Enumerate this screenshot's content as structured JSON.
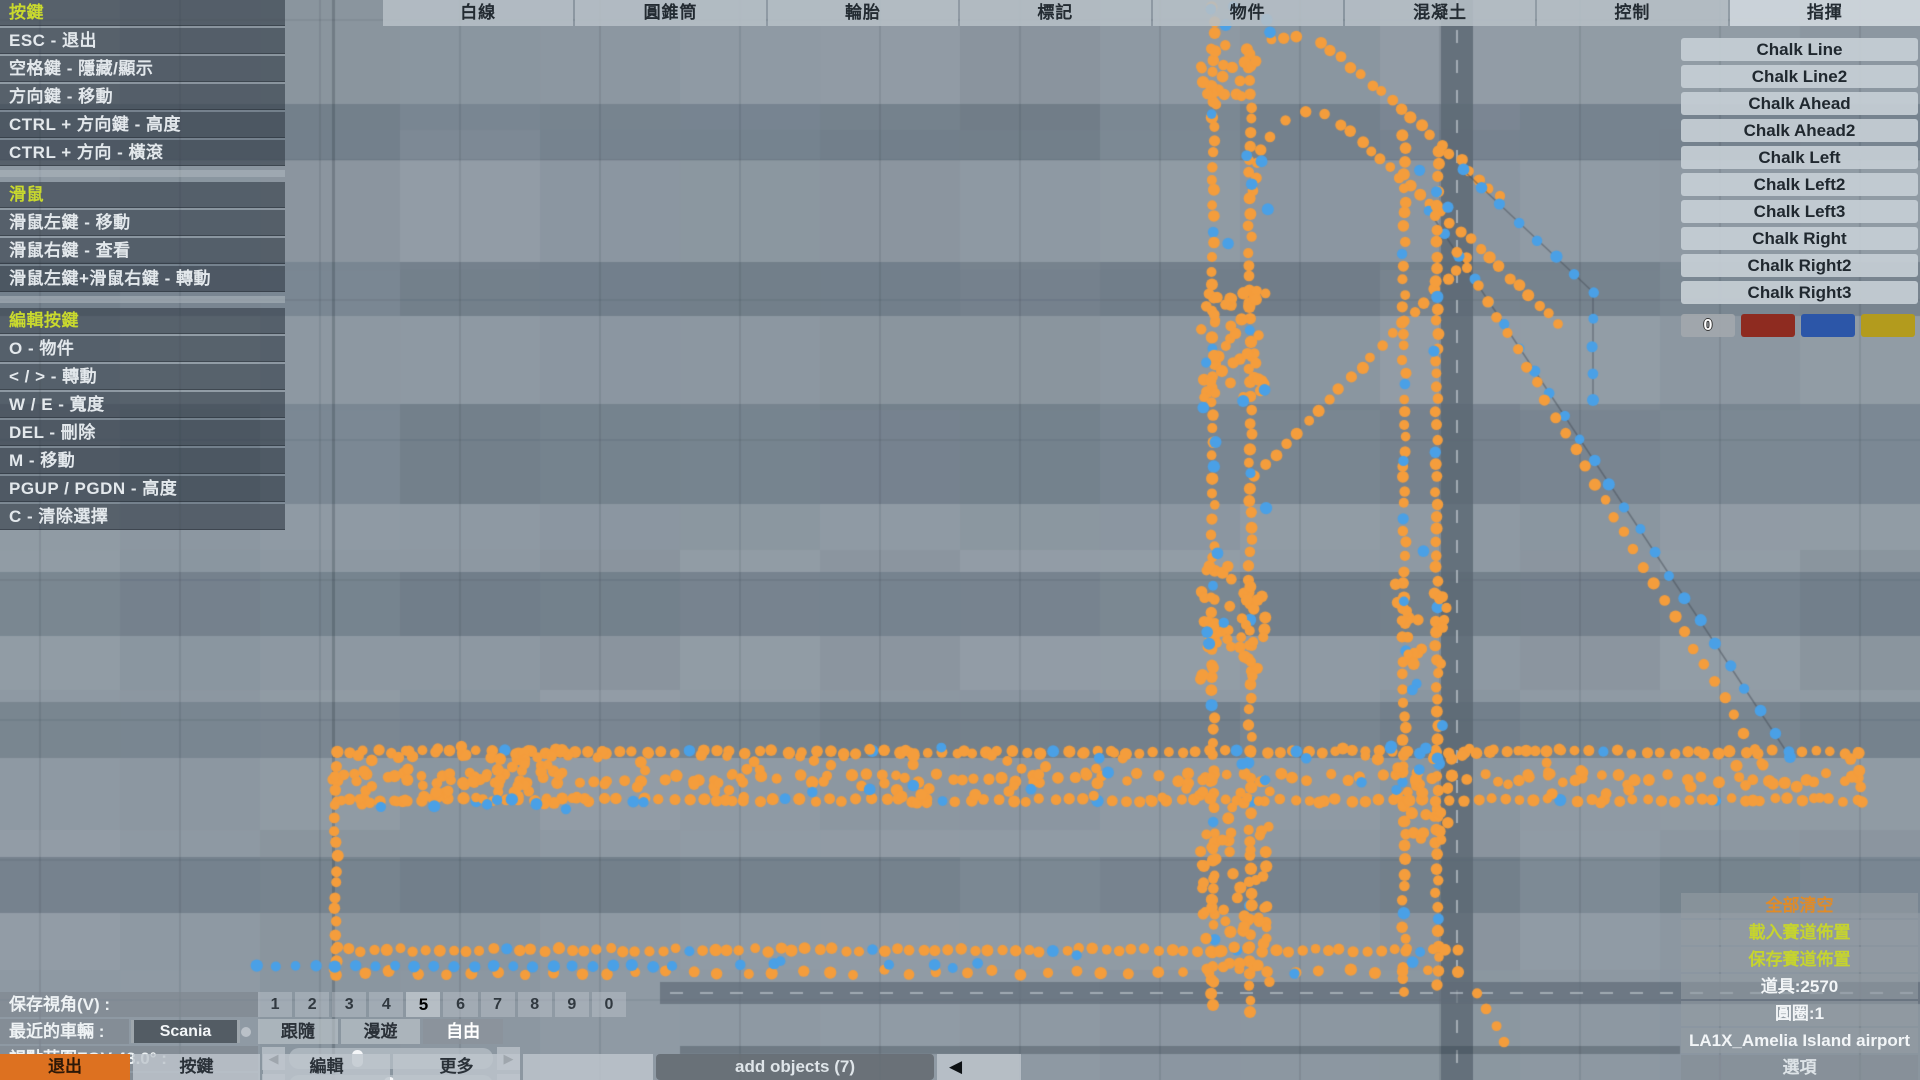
{
  "help_panel": {
    "sections": [
      {
        "title": "按鍵",
        "items": [
          "ESC - 退出",
          "空格鍵 - 隱藏/顯示",
          "方向鍵 - 移動",
          "CTRL + 方向鍵 - 高度",
          "CTRL + 方向 - 橫滾"
        ]
      },
      {
        "title": "滑鼠",
        "items": [
          "滑鼠左鍵 - 移動",
          "滑鼠右鍵 - 查看",
          "滑鼠左鍵+滑鼠右鍵 - 轉動"
        ]
      },
      {
        "title": "編輯按鍵",
        "items": [
          "O - 物件",
          "< / > - 轉動",
          "W / E - 寬度",
          "DEL - 刪除",
          "M - 移動",
          "PGUP / PGDN - 高度",
          "C - 清除選擇"
        ]
      }
    ]
  },
  "tabs": [
    "白線",
    "圓錐筒",
    "輪胎",
    "標記",
    "物件",
    "混凝土",
    "控制",
    "指揮"
  ],
  "active_tab": "指揮",
  "chalk_panel": {
    "items": [
      "Chalk Line",
      "Chalk Line2",
      "Chalk Ahead",
      "Chalk Ahead2",
      "Chalk Left",
      "Chalk Left2",
      "Chalk Left3",
      "Chalk Right",
      "Chalk Right2",
      "Chalk Right3"
    ],
    "zero_label": "0",
    "swatches": [
      "#8e2b20",
      "#2c56a8",
      "#b39b1d"
    ]
  },
  "view_controls": {
    "save_view_label": "保存視角(V) :",
    "view_slots": [
      "1",
      "2",
      "3",
      "4",
      "5",
      "6",
      "7",
      "8",
      "9",
      "0"
    ],
    "active_slot": "5",
    "recent_vehicle_label": "最近的車輛 :",
    "recent_vehicle_value": "Scania",
    "camera_modes": [
      "跟隨",
      "漫遊",
      "自由"
    ],
    "active_camera_mode": "自由",
    "fov_label": "視點范圍FOV 43.0° :",
    "fov_thumb_pos": 0.32,
    "roll_label": "橫滾 0.0° :",
    "roll_thumb_pos": 0.49
  },
  "bottom_bar": {
    "exit": "退出",
    "keys": "按鍵",
    "edit": "編輯",
    "more": "更多",
    "add_objects": "add objects (7)",
    "options": "選項"
  },
  "session_panel": {
    "clear_all": "全部清空",
    "load_track": "載入賽道佈置",
    "save_track": "保存賽道佈置",
    "props_count": "道具:2570",
    "circles_count": "圓圈:1",
    "map_name": "LA1X_Amelia Island airport"
  },
  "icons": {
    "left_arrow": "◀",
    "right_arrow": "▶",
    "collapse_arrow": "◀"
  },
  "map": {
    "colors": {
      "orange": "#f49d3c",
      "blue": "#4aa0e6",
      "link_line": "rgba(70,78,88,0.5)"
    },
    "background": {
      "base": "#8e99a3",
      "band_color": "rgba(110,123,136,0.55)",
      "bands": [
        [
          104,
          56
        ],
        [
          262,
          54
        ],
        [
          404,
          100
        ],
        [
          572,
          64
        ],
        [
          702,
          56
        ],
        [
          857,
          56
        ]
      ],
      "slab_size": 140,
      "v_road": {
        "x": 1441,
        "w": 32
      },
      "h_road": {
        "x": 660,
        "y": 982,
        "h": 22
      },
      "thin_vline_x": 333,
      "shadow_strip": [
        680,
        1046,
        1000,
        8
      ]
    },
    "tracks": [
      {
        "kind": "line",
        "color": "orange",
        "pts": [
          [
            1213,
            118
          ],
          [
            1218,
            90
          ],
          [
            1230,
            66
          ],
          [
            1248,
            48
          ],
          [
            1270,
            38
          ],
          [
            1296,
            35
          ],
          [
            1320,
            43
          ],
          [
            1342,
            58
          ],
          [
            1500,
            196
          ]
        ],
        "spacing": 13,
        "jitter": 2
      },
      {
        "kind": "line",
        "color": "orange",
        "pts": [
          [
            1252,
            192
          ],
          [
            1257,
            162
          ],
          [
            1268,
            138
          ],
          [
            1284,
            120
          ],
          [
            1304,
            110
          ],
          [
            1324,
            112
          ],
          [
            1342,
            124
          ],
          [
            1460,
            230
          ],
          [
            1558,
            324
          ]
        ],
        "spacing": 13,
        "jitter": 2
      },
      {
        "kind": "line",
        "color": "blue",
        "pts": [
          [
            1463,
            170
          ],
          [
            1593,
            292
          ],
          [
            1593,
            400
          ]
        ],
        "spacing": 23,
        "jitter": 1,
        "link": true
      },
      {
        "kind": "line",
        "color": "orange",
        "pts": [
          [
            1468,
            258
          ],
          [
            1254,
            476
          ]
        ],
        "spacing": 15,
        "jitter": 2
      },
      {
        "kind": "line",
        "color": "blue",
        "pts": [
          [
            1429,
            211
          ],
          [
            1790,
            757
          ]
        ],
        "spacing": 27,
        "jitter": 1,
        "link": true
      },
      {
        "kind": "line",
        "color": "orange",
        "pts": [
          [
            1457,
            251
          ],
          [
            1763,
            765
          ]
        ],
        "spacing": 19,
        "jitter": 2
      },
      {
        "kind": "line",
        "color": "orange",
        "pts": [
          [
            1213,
            8
          ],
          [
            1213,
            1005
          ]
        ],
        "spacing": 13,
        "jitter": 2,
        "blue_every": 9
      },
      {
        "kind": "line",
        "color": "orange",
        "pts": [
          [
            1250,
            55
          ],
          [
            1250,
            1012
          ]
        ],
        "spacing": 13,
        "jitter": 2,
        "blue_every": 11
      },
      {
        "kind": "line",
        "color": "orange",
        "pts": [
          [
            1404,
            135
          ],
          [
            1404,
            992
          ]
        ],
        "spacing": 13,
        "jitter": 2,
        "blue_every": 10
      },
      {
        "kind": "line",
        "color": "orange",
        "pts": [
          [
            1437,
            152
          ],
          [
            1437,
            985
          ]
        ],
        "spacing": 13,
        "jitter": 2,
        "blue_every": 12
      },
      {
        "kind": "line",
        "color": "orange",
        "pts": [
          [
            336,
            752
          ],
          [
            1858,
            752
          ]
        ],
        "spacing": 14,
        "jitter": 2,
        "blue_every": 13
      },
      {
        "kind": "line",
        "color": "orange",
        "pts": [
          [
            336,
            800
          ],
          [
            1858,
            800
          ]
        ],
        "spacing": 14,
        "jitter": 2,
        "blue_every": 11
      },
      {
        "kind": "line",
        "color": "orange",
        "pts": [
          [
            336,
            778
          ],
          [
            1858,
            778
          ]
        ],
        "spacing": 17,
        "jitter": 5
      },
      {
        "kind": "scatter",
        "color": "orange",
        "box": [
          336,
          748,
          1520,
          56
        ],
        "count": 130
      },
      {
        "kind": "scatter",
        "color": "orange",
        "box": [
          336,
          745,
          270,
          60
        ],
        "count": 55
      },
      {
        "kind": "line",
        "color": "orange",
        "pts": [
          [
            425,
            798
          ],
          [
            562,
            750
          ]
        ],
        "spacing": 13,
        "jitter": 2
      },
      {
        "kind": "line",
        "color": "orange",
        "pts": [
          [
            336,
            752
          ],
          [
            336,
            975
          ]
        ],
        "spacing": 13,
        "jitter": 2
      },
      {
        "kind": "line",
        "color": "orange",
        "pts": [
          [
            336,
            950
          ],
          [
            1458,
            950
          ]
        ],
        "spacing": 13,
        "jitter": 2,
        "blue_every": 14
      },
      {
        "kind": "line",
        "color": "orange",
        "pts": [
          [
            336,
            972
          ],
          [
            1458,
            972
          ]
        ],
        "spacing": 27,
        "jitter": 3
      },
      {
        "kind": "line",
        "color": "blue",
        "pts": [
          [
            256,
            966
          ],
          [
            672,
            966
          ]
        ],
        "spacing": 19,
        "jitter": 1
      },
      {
        "kind": "scatter",
        "color": "orange",
        "box": [
          1200,
          285,
          66,
          120
        ],
        "count": 42
      },
      {
        "kind": "scatter",
        "color": "orange",
        "box": [
          1200,
          565,
          66,
          120
        ],
        "count": 42
      },
      {
        "kind": "scatter",
        "color": "orange",
        "box": [
          1200,
          775,
          70,
          210
        ],
        "count": 65
      },
      {
        "kind": "scatter",
        "color": "orange",
        "box": [
          1392,
          580,
          56,
          85
        ],
        "count": 22
      },
      {
        "kind": "scatter",
        "color": "orange",
        "box": [
          1390,
          748,
          62,
          92
        ],
        "count": 28
      },
      {
        "kind": "scatter",
        "color": "orange",
        "box": [
          1196,
          40,
          62,
          60
        ],
        "count": 16
      },
      {
        "kind": "scatter",
        "color": "blue",
        "box": [
          1192,
          6,
          80,
          46
        ],
        "count": 5
      },
      {
        "kind": "line",
        "color": "orange",
        "pts": [
          [
            1478,
            995
          ],
          [
            1504,
            1042
          ]
        ],
        "spacing": 14,
        "jitter": 2
      },
      {
        "kind": "line",
        "color": "orange",
        "pts": [
          [
            1858,
            754
          ],
          [
            1862,
            802
          ]
        ],
        "spacing": 13,
        "jitter": 1
      },
      {
        "kind": "scatter",
        "color": "blue",
        "box": [
          340,
          798,
          330,
          14
        ],
        "count": 8
      },
      {
        "kind": "scatter",
        "color": "blue",
        "box": [
          700,
          944,
          760,
          34
        ],
        "count": 10
      },
      {
        "kind": "scatter",
        "color": "blue",
        "box": [
          1200,
          60,
          70,
          620
        ],
        "count": 14
      },
      {
        "kind": "scatter",
        "color": "blue",
        "box": [
          1396,
          160,
          52,
          600
        ],
        "count": 12
      },
      {
        "kind": "scatter",
        "color": "blue",
        "box": [
          700,
          746,
          1100,
          58
        ],
        "count": 16
      }
    ]
  }
}
